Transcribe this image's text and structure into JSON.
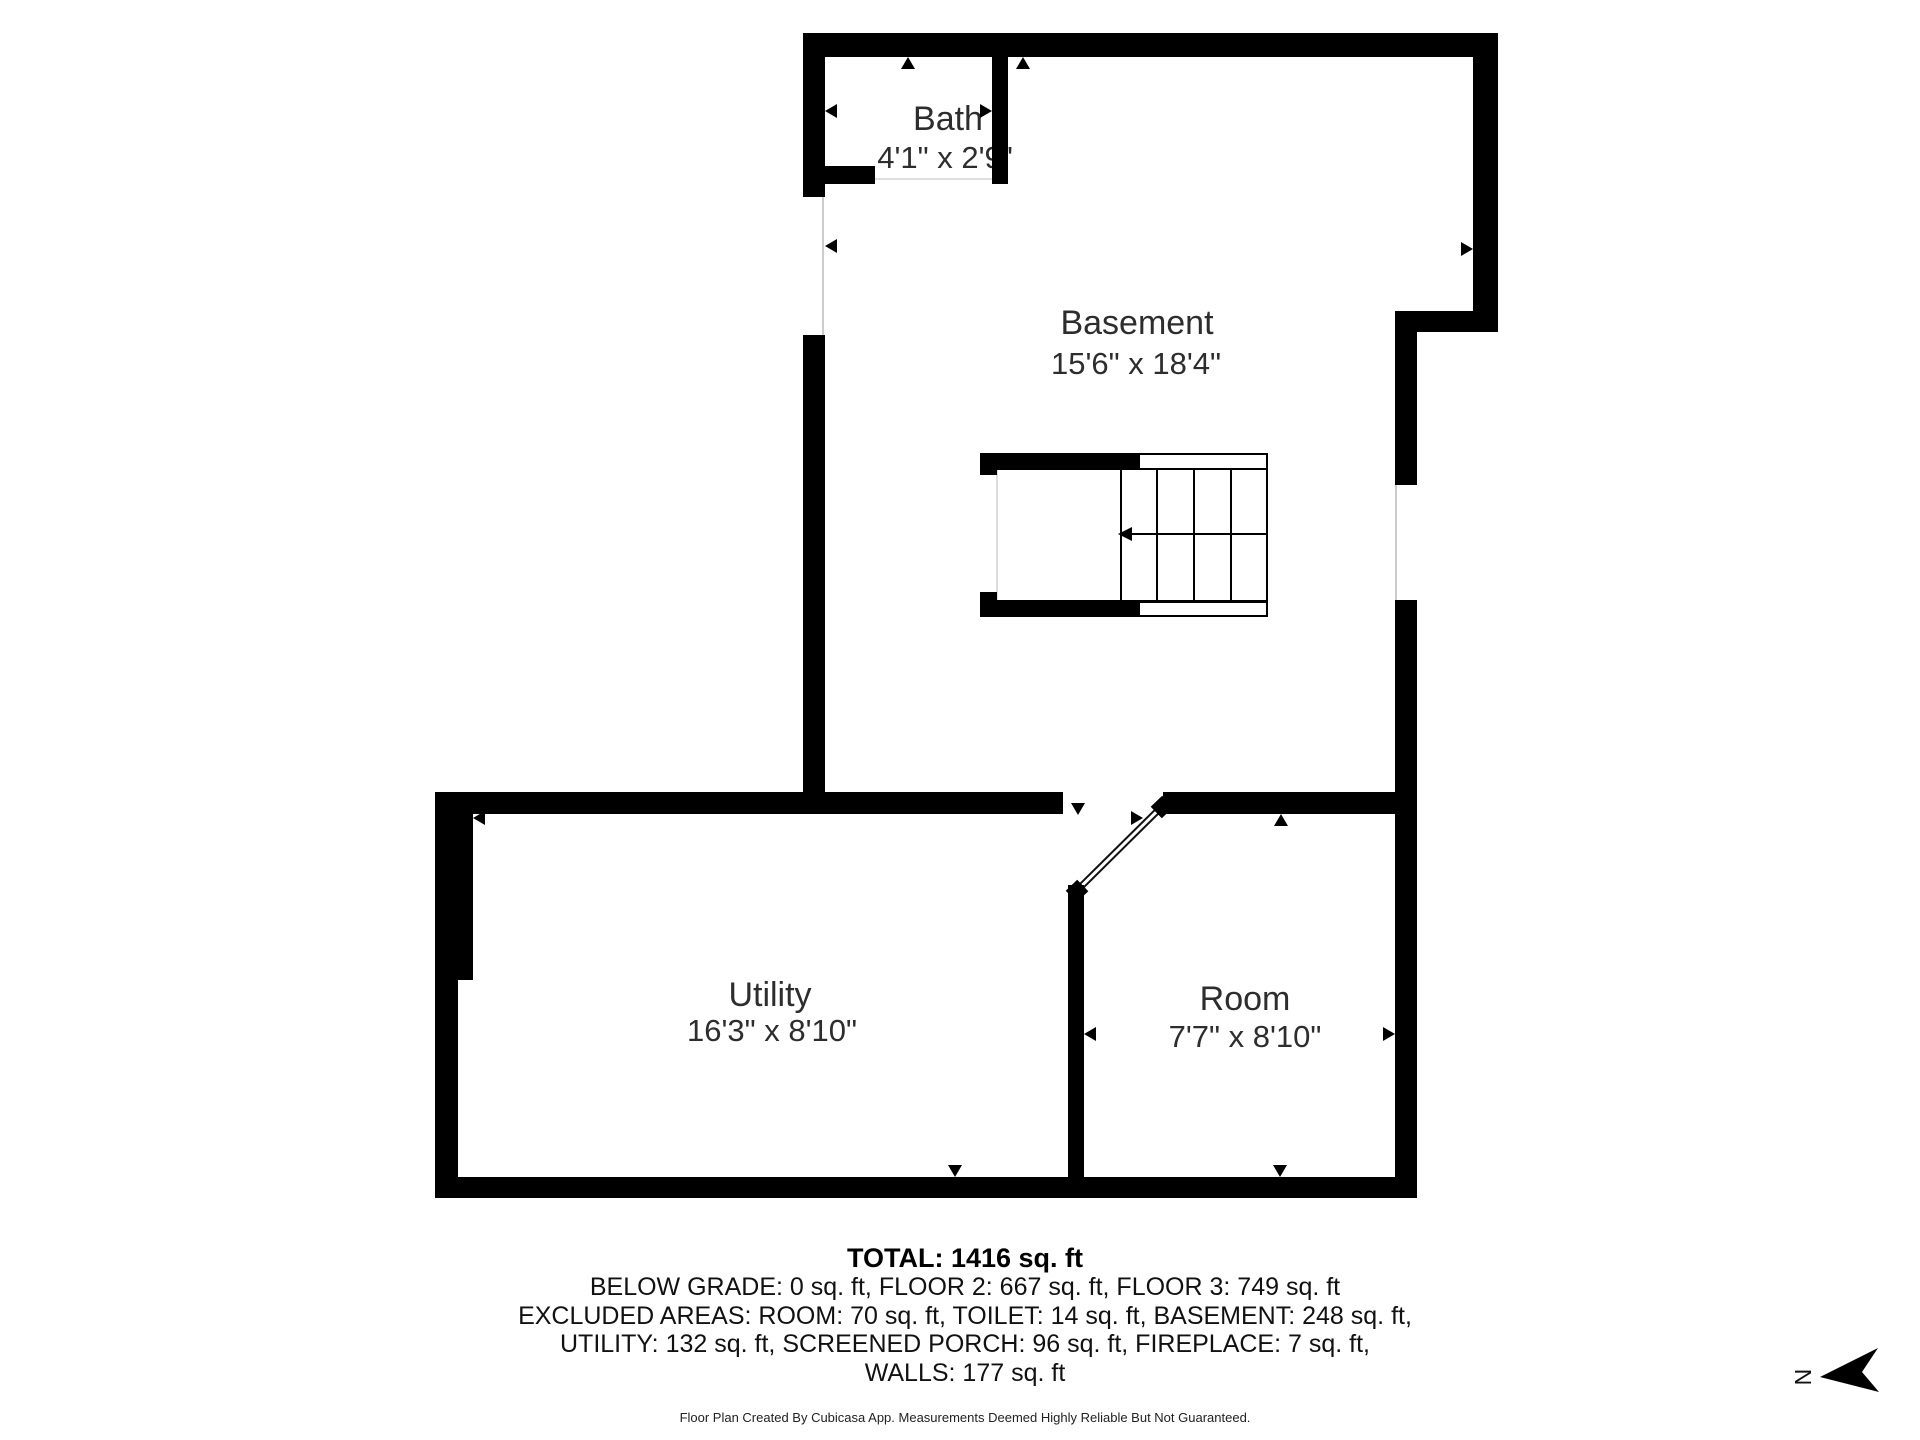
{
  "rooms": [
    {
      "name": "Bath",
      "dims": "4'1\" x 2'9\""
    },
    {
      "name": "Basement",
      "dims": "15'6\" x 18'4\""
    },
    {
      "name": "Utility",
      "dims": "16'3\" x 8'10\""
    },
    {
      "name": "Room",
      "dims": "7'7\" x 8'10\""
    }
  ],
  "summary": {
    "total": "TOTAL: 1416 sq. ft",
    "breakdown": [
      "BELOW GRADE: 0 sq. ft, FLOOR 2: 667 sq. ft, FLOOR 3: 749 sq. ft",
      "EXCLUDED AREAS: ROOM: 70 sq. ft, TOILET: 14 sq. ft, BASEMENT: 248 sq. ft,",
      "UTILITY: 132 sq. ft, SCREENED PORCH: 96 sq. ft, FIREPLACE: 7 sq. ft,",
      "WALLS: 177 sq. ft"
    ]
  },
  "footer": {
    "disclaimer": "Floor Plan Created By Cubicasa App. Measurements Deemed Highly Reliable But Not Guaranteed."
  },
  "compass": {
    "label": "N"
  },
  "colors": {
    "wall": "#000000",
    "text": "#2d2d2d",
    "opening_line": "#cccccc"
  }
}
